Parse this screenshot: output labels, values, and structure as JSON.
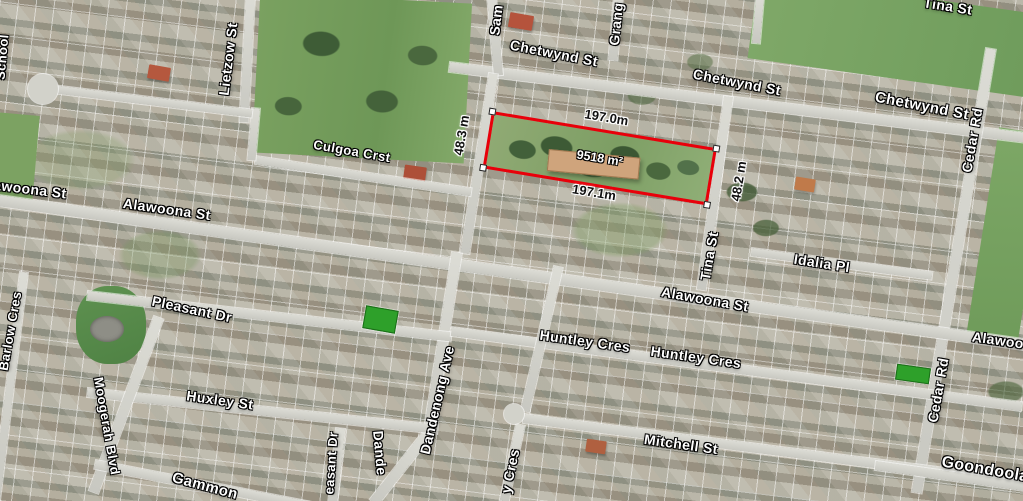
{
  "map": {
    "view_type": "satellite-aerial",
    "streets": [
      {
        "id": "chetwynd-st-1",
        "text": "Chetwynd St"
      },
      {
        "id": "chetwynd-st-2",
        "text": "Chetwynd St"
      },
      {
        "id": "chetwynd-st-3",
        "text": "Chetwynd St"
      },
      {
        "id": "tina-st-top",
        "text": "Tina St"
      },
      {
        "id": "sam-st-partial",
        "text": "Sam"
      },
      {
        "id": "grange-partial",
        "text": "Grang"
      },
      {
        "id": "school-partial",
        "text": "School"
      },
      {
        "id": "lietzow-st",
        "text": "Lietzow St"
      },
      {
        "id": "cedar-rd-top",
        "text": "Cedar Rd"
      },
      {
        "id": "culgoa-crst",
        "text": "Culgoa Crst"
      },
      {
        "id": "alawoona-st-left-partial",
        "text": "awoona St"
      },
      {
        "id": "alawoona-st-left",
        "text": "Alawoona St"
      },
      {
        "id": "alawoona-st-center",
        "text": "Alawoona St"
      },
      {
        "id": "alawoona-st-right-partial",
        "text": "Alawoo"
      },
      {
        "id": "tina-st-mid",
        "text": "Tina St"
      },
      {
        "id": "idalia-pl",
        "text": "Idalia Pl"
      },
      {
        "id": "pleasant-dr",
        "text": "Pleasant Dr"
      },
      {
        "id": "huxley-st",
        "text": "Huxley St"
      },
      {
        "id": "moogerah-blvd",
        "text": "Moogerah Blvd"
      },
      {
        "id": "barlow-cres",
        "text": "Barlow Cres"
      },
      {
        "id": "dandenong-ave",
        "text": "Dandenong Ave"
      },
      {
        "id": "huntley-cres-1",
        "text": "Huntley Cres"
      },
      {
        "id": "huntley-cres-2",
        "text": "Huntley Cres"
      },
      {
        "id": "mitchell-st",
        "text": "Mitchell St"
      },
      {
        "id": "cedar-rd-bottom",
        "text": "Cedar Rd"
      },
      {
        "id": "pleasant-dr-bottom-partial",
        "text": "easant Dr"
      },
      {
        "id": "dandenong-bottom-partial",
        "text": "Dande"
      },
      {
        "id": "y-cres-partial",
        "text": "y Cres"
      },
      {
        "id": "gammon-partial",
        "text": "Gammon"
      },
      {
        "id": "goondoola-partial",
        "text": "Goondoola"
      }
    ],
    "parcel_measurement": {
      "length_top": "197.0m",
      "length_bottom": "197.1m",
      "width_left": "48.3 m",
      "width_right": "48.2 m",
      "area": "9518 m²"
    },
    "colors": {
      "parcel_outline": "#e8000a",
      "corner_marker": "#ffffff",
      "highlight_lot": "#2ea02a",
      "street_label_text": "#ffffff",
      "dimension_text": "#111111"
    }
  }
}
